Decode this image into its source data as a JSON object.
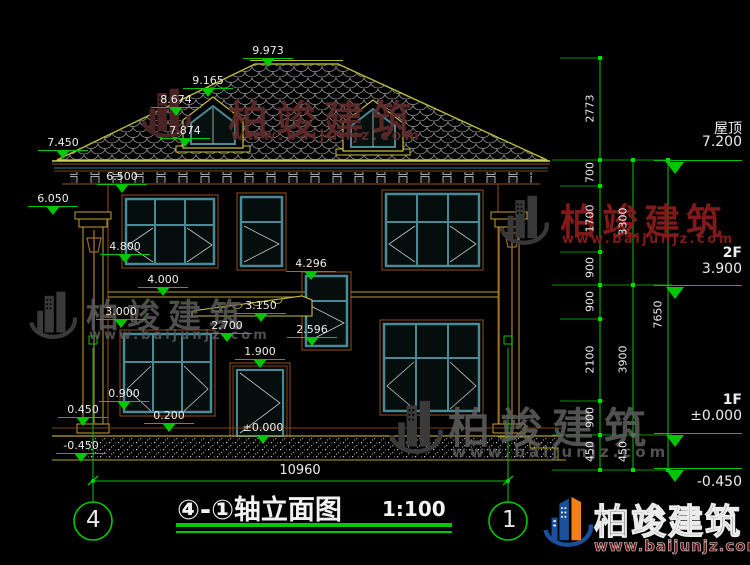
{
  "title": {
    "combined": "④-①轴立面图",
    "scale": "1:100"
  },
  "axis_bubbles": {
    "left": "4",
    "right": "1"
  },
  "overall_dim": "10960",
  "left_marks": [
    "9.973",
    "9.165",
    "8.674",
    "7.874",
    "7.450",
    "6.500",
    "6.050",
    "4.800",
    "4.000",
    "3.000",
    "0.900",
    "0.450",
    "-0.450",
    "0.200",
    "1.900",
    "±0.000",
    "2.700",
    "3.150",
    "2.596",
    "4.296"
  ],
  "right_chains": {
    "a": [
      "2773",
      "700",
      "1700",
      "900",
      "900",
      "2100",
      "900",
      "450"
    ],
    "b": [
      "3300",
      "3900",
      "450"
    ],
    "c": [
      "7650"
    ]
  },
  "floor_levels": [
    {
      "name": "屋顶",
      "value": "7.200"
    },
    {
      "name": "2F",
      "value": "3.900"
    },
    {
      "name": "1F",
      "value": "±0.000"
    },
    {
      "name": "",
      "value": "-0.450"
    }
  ],
  "watermark": {
    "brand": "柏竣建筑",
    "url": "www.baijunjz.com"
  },
  "colors": {
    "dim_green": "#00c800",
    "roof_yellow": "#b5b53a",
    "window_teal": "#4a8a96",
    "trim_brown": "#7a4418",
    "brand_red": "#8c1a1a",
    "logo_blue": "#1a4f9c",
    "logo_orange": "#f08018"
  }
}
